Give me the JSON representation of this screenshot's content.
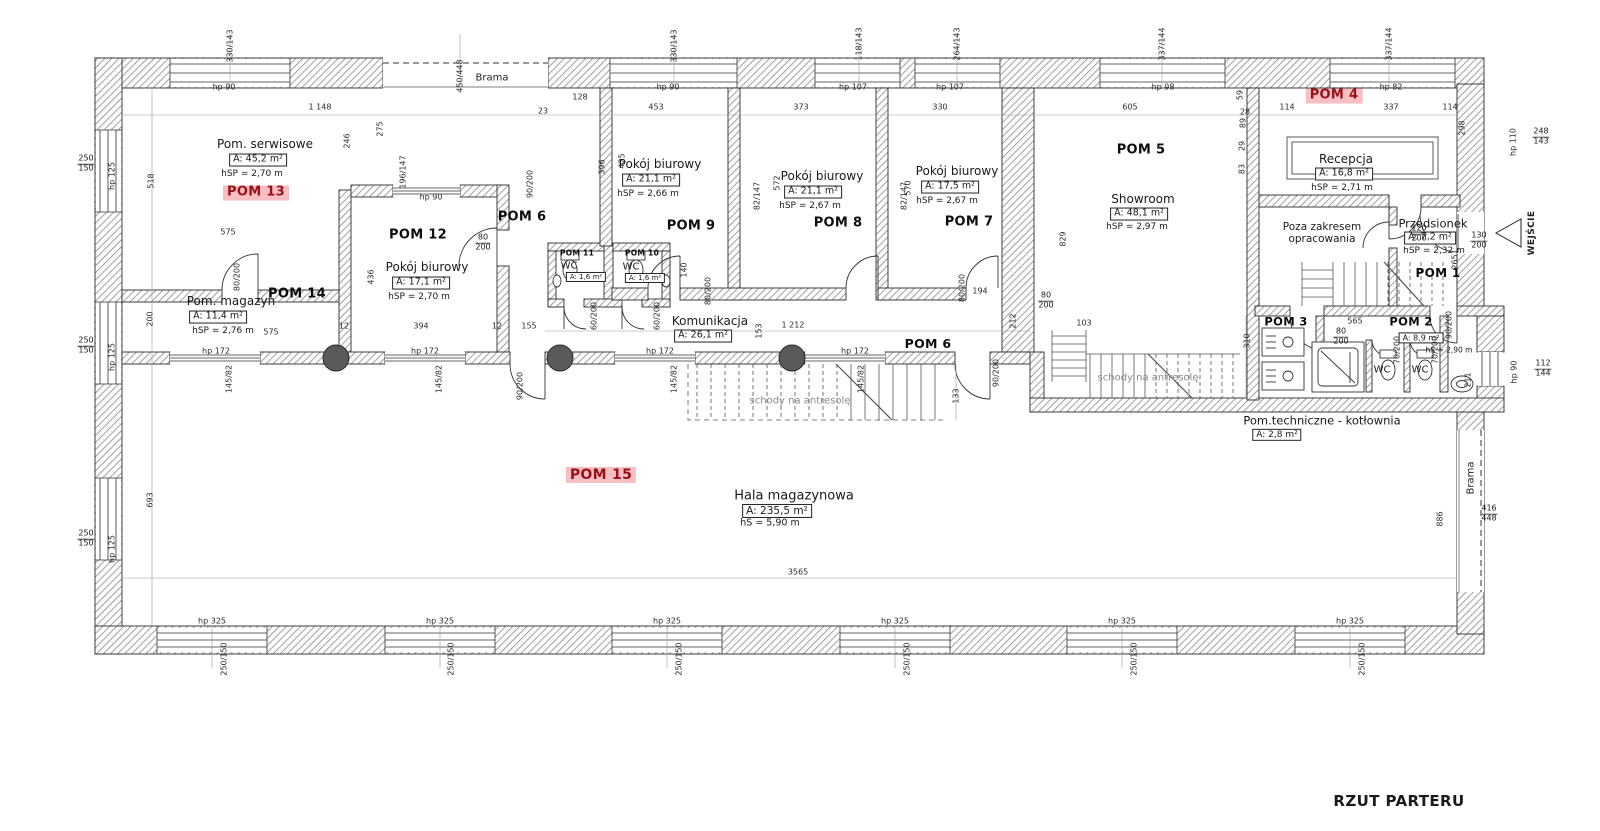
{
  "title": "RZUT PARTERU",
  "colors": {
    "highlight_bg": "#f7bfc4",
    "highlight_text": "#9a1016",
    "wall_hatch": "#8a8a8a"
  },
  "rooms": [
    {
      "key": "pom13",
      "id": "POM 13",
      "hl": true,
      "name": "Pom. serwisowe",
      "area": "A: 45,2 m²",
      "height": "hSP = 2,70 m",
      "bpos": [
        256,
        193
      ],
      "npos": [
        265,
        145
      ],
      "apos": [
        258,
        160
      ],
      "hpos": [
        252,
        174
      ]
    },
    {
      "key": "pom12",
      "id": "POM 12",
      "hl": false,
      "name": "Pokój biurowy",
      "area": "A: 17,1 m²",
      "height": "hSP = 2,70 m",
      "bpos": [
        418,
        236
      ],
      "npos": [
        427,
        268
      ],
      "apos": [
        421,
        283
      ],
      "hpos": [
        419,
        297
      ]
    },
    {
      "key": "pom14",
      "id": "POM 14",
      "hl": false,
      "name": "Pom. magazyn",
      "area": "A: 11,4 m²",
      "height": "hSP = 2,76 m",
      "bpos": [
        297,
        295
      ],
      "npos": [
        231,
        302
      ],
      "apos": [
        218,
        317
      ],
      "hpos": [
        223,
        331
      ]
    },
    {
      "key": "pom6-upper",
      "id": "POM 6",
      "hl": false,
      "name": null,
      "area": null,
      "height": null,
      "bpos": [
        522,
        218
      ]
    },
    {
      "key": "pom9",
      "id": "POM 9",
      "hl": false,
      "name": "Pokój biurowy",
      "area": "A: 21,1 m²",
      "height": "hSP = 2,66 m",
      "bpos": [
        691,
        227
      ],
      "npos": [
        660,
        165
      ],
      "apos": [
        651,
        180
      ],
      "hpos": [
        648,
        194
      ]
    },
    {
      "key": "pom8",
      "id": "POM 8",
      "hl": false,
      "name": "Pokój biurowy",
      "area": "A: 21,1 m²",
      "height": "hSP = 2,67 m",
      "bpos": [
        838,
        224
      ],
      "npos": [
        822,
        177
      ],
      "apos": [
        813,
        192
      ],
      "hpos": [
        810,
        206
      ]
    },
    {
      "key": "pom7",
      "id": "POM 7",
      "hl": false,
      "name": "Pokój biurowy",
      "area": "A: 17,5 m²",
      "height": "hSP = 2,67 m",
      "bpos": [
        969,
        223
      ],
      "npos": [
        957,
        172
      ],
      "apos": [
        950,
        187
      ],
      "hpos": [
        947,
        201
      ]
    },
    {
      "key": "pom5",
      "id": "POM 5",
      "hl": false,
      "name": "Showroom",
      "area": "A: 48,1 m²",
      "height": "hSP = 2,97 m",
      "bpos": [
        1141,
        151
      ],
      "npos": [
        1143,
        200
      ],
      "apos": [
        1139,
        214
      ],
      "hpos": [
        1137,
        227
      ]
    },
    {
      "key": "pom4",
      "id": "POM 4",
      "hl": true,
      "name": "Recepcja",
      "area": "A: 16,8 m²",
      "height": "hSP = 2,71 m",
      "bpos": [
        1334,
        96
      ],
      "npos": [
        1346,
        160
      ],
      "apos": [
        1344,
        174
      ],
      "hpos": [
        1342,
        188
      ]
    },
    {
      "key": "pom1",
      "id": "POM 1",
      "hl": false,
      "name": "Przedsionek",
      "area": "A: 7,2 m²",
      "height": "hSP = 2,32 m",
      "bpos": [
        1438,
        274
      ],
      "npos": [
        1433,
        224
      ],
      "apos": [
        1430,
        238
      ],
      "hpos": [
        1434,
        251
      ],
      "f": {
        "b": 12,
        "n": 11.5
      }
    },
    {
      "key": "pom11",
      "id": "POM 11",
      "hl": false,
      "name": "WC",
      "area": "A: 1,6 m²",
      "height": null,
      "bpos": [
        577,
        254
      ],
      "npos": [
        569,
        266
      ],
      "apos": [
        586,
        277
      ],
      "f": {
        "b": 7.5,
        "n": 10,
        "a": 7
      }
    },
    {
      "key": "pom10",
      "id": "POM 10",
      "hl": false,
      "name": "WC",
      "area": "A: 1,6 m²",
      "height": null,
      "bpos": [
        642,
        254
      ],
      "npos": [
        631,
        267
      ],
      "apos": [
        645,
        278
      ],
      "f": {
        "b": 7.5,
        "n": 10,
        "a": 7
      }
    },
    {
      "key": "komunikacja",
      "id": "POM 6",
      "hl": false,
      "name": "Komunikacja",
      "area": "A: 26,1 m²",
      "height": null,
      "bpos": [
        928,
        344
      ],
      "npos": [
        710,
        322
      ],
      "apos": [
        703,
        336
      ],
      "f": {
        "b": 12.5
      }
    },
    {
      "key": "pom3",
      "id": "POM 3",
      "hl": false,
      "name": null,
      "area": null,
      "height": null,
      "bpos": [
        1286,
        322
      ],
      "f": {
        "b": 11.5
      }
    },
    {
      "key": "pom2",
      "id": "POM 2",
      "hl": false,
      "name": null,
      "area": "A: 8,9 m²",
      "height": "hS = 2,90 m",
      "bpos": [
        1411,
        322
      ],
      "apos": [
        1421,
        338
      ],
      "hpos": [
        1449,
        351
      ],
      "f": {
        "b": 11.5,
        "a": 8,
        "h": 7.5
      }
    },
    {
      "key": "wc-left",
      "id": null,
      "hl": false,
      "name": "WC",
      "area": null,
      "height": null,
      "npos": [
        1382,
        370
      ],
      "f": {
        "n": 10
      }
    },
    {
      "key": "wc-right",
      "id": null,
      "hl": false,
      "name": "WC",
      "area": null,
      "height": null,
      "npos": [
        1420,
        370
      ],
      "f": {
        "n": 10
      }
    },
    {
      "key": "kotlownia",
      "id": null,
      "hl": false,
      "name": "Pom.techniczne - kotłownia",
      "area": "A: 2,8 m²",
      "height": null,
      "npos": [
        1322,
        421
      ],
      "apos": [
        1277,
        435
      ],
      "f": {
        "n": 11.5,
        "a": 9
      }
    },
    {
      "key": "pom15",
      "id": "POM 15",
      "hl": true,
      "name": "Hala magazynowa",
      "area": "A: 235,5 m²",
      "height": "hS = 5,90 m",
      "bpos": [
        601,
        475
      ],
      "npos": [
        794,
        497
      ],
      "apos": [
        777,
        511
      ],
      "hpos": [
        770,
        524
      ],
      "f": {
        "b": 14,
        "n": 13,
        "a": 10.5,
        "h": 9.5
      }
    },
    {
      "key": "poza-zakresem",
      "id": null,
      "hl": false,
      "name": "Poza zakresem\nopracowania",
      "area": null,
      "height": null,
      "npos": [
        1322,
        233
      ],
      "multi": true,
      "f": {
        "n": 10.5
      }
    }
  ],
  "annotations": [
    {
      "t": "Brama",
      "x": 492,
      "y": 78,
      "fl": ""
    },
    {
      "t": "Brama",
      "x": 1471,
      "y": 478,
      "fl": "r"
    },
    {
      "t": "WEJŚCIE",
      "x": 1532,
      "y": 233,
      "fl": "r b"
    },
    {
      "t": "schody na antresolę",
      "x": 800,
      "y": 401,
      "fl": "g"
    },
    {
      "t": "schody na antresolę",
      "x": 1148,
      "y": 378,
      "fl": "g"
    }
  ],
  "dims": [
    [
      "1 148",
      320,
      107,
      ""
    ],
    [
      "23",
      543,
      111,
      ""
    ],
    [
      "128",
      580,
      97,
      ""
    ],
    [
      "453",
      656,
      107,
      ""
    ],
    [
      "373",
      801,
      107,
      ""
    ],
    [
      "330",
      940,
      107,
      ""
    ],
    [
      "605",
      1130,
      107,
      ""
    ],
    [
      "28",
      1245,
      112,
      ""
    ],
    [
      "114",
      1287,
      107,
      ""
    ],
    [
      "337",
      1391,
      107,
      ""
    ],
    [
      "114",
      1450,
      107,
      ""
    ],
    [
      "330/143",
      230,
      46,
      "r"
    ],
    [
      "450/448",
      460,
      76,
      "r"
    ],
    [
      "330/143",
      674,
      46,
      "r"
    ],
    [
      "118/143",
      859,
      44,
      "r"
    ],
    [
      "264/143",
      957,
      44,
      "r"
    ],
    [
      "337/144",
      1162,
      44,
      "r"
    ],
    [
      "337/144",
      1389,
      44,
      "r"
    ],
    [
      "hp 90",
      224,
      87,
      ""
    ],
    [
      "hp 90",
      668,
      87,
      ""
    ],
    [
      "hp 107",
      853,
      87,
      ""
    ],
    [
      "hp 107",
      950,
      87,
      ""
    ],
    [
      "hp 98",
      1163,
      87,
      ""
    ],
    [
      "hp 82",
      1391,
      87,
      ""
    ],
    [
      "250/150",
      86,
      164,
      "f"
    ],
    [
      "250/150",
      86,
      346,
      "f"
    ],
    [
      "250/150",
      86,
      539,
      "f"
    ],
    [
      "hp 125",
      112,
      176,
      "r"
    ],
    [
      "hp 125",
      112,
      357,
      "r"
    ],
    [
      "hp 125",
      112,
      549,
      "r"
    ],
    [
      "518",
      151,
      181,
      "r"
    ],
    [
      "200",
      150,
      319,
      "r"
    ],
    [
      "693",
      150,
      500,
      "r"
    ],
    [
      "275",
      380,
      129,
      "r"
    ],
    [
      "246",
      347,
      141,
      "r"
    ],
    [
      "436",
      371,
      277,
      "r"
    ],
    [
      "396",
      602,
      167,
      "r"
    ],
    [
      "425",
      622,
      161,
      "r"
    ],
    [
      "572",
      777,
      183,
      "r"
    ],
    [
      "570",
      908,
      188,
      "r"
    ],
    [
      "829",
      1063,
      239,
      "r"
    ],
    [
      "59",
      1240,
      95,
      "r"
    ],
    [
      "89",
      1243,
      123,
      "r"
    ],
    [
      "29",
      1242,
      146,
      "r"
    ],
    [
      "83",
      1242,
      169,
      "r"
    ],
    [
      "298",
      1462,
      128,
      "r"
    ],
    [
      "248/143",
      1541,
      137,
      "f"
    ],
    [
      "hp 110",
      1513,
      142,
      "r"
    ],
    [
      "120/200",
      1419,
      234,
      "f"
    ],
    [
      "130/200",
      1479,
      241,
      "f"
    ],
    [
      "265",
      1455,
      262,
      "r"
    ],
    [
      "196/147",
      403,
      172,
      "r"
    ],
    [
      "hp 90",
      431,
      197,
      ""
    ],
    [
      "90/200",
      530,
      184,
      "r"
    ],
    [
      "80/200",
      483,
      243,
      "f"
    ],
    [
      "80/200",
      237,
      277,
      "r"
    ],
    [
      "82/147",
      757,
      196,
      "r"
    ],
    [
      "82/147",
      904,
      196,
      "r"
    ],
    [
      "80/200",
      708,
      291,
      "r"
    ],
    [
      "80/200",
      962,
      288,
      "r"
    ],
    [
      "60/200",
      594,
      316,
      "r"
    ],
    [
      "60/200",
      657,
      316,
      "r"
    ],
    [
      "140",
      684,
      270,
      "r"
    ],
    [
      "194",
      980,
      291,
      ""
    ],
    [
      "575",
      228,
      232,
      ""
    ],
    [
      "575",
      271,
      332,
      ""
    ],
    [
      "12",
      344,
      326,
      ""
    ],
    [
      "394",
      421,
      326,
      ""
    ],
    [
      "12",
      497,
      326,
      ""
    ],
    [
      "155",
      529,
      326,
      ""
    ],
    [
      "153",
      759,
      331,
      "r"
    ],
    [
      "1 212",
      793,
      325,
      ""
    ],
    [
      "hp 172",
      216,
      351,
      ""
    ],
    [
      "hp 172",
      425,
      351,
      ""
    ],
    [
      "hp 172",
      660,
      351,
      ""
    ],
    [
      "hp 172",
      855,
      351,
      ""
    ],
    [
      "145/82",
      229,
      379,
      "r"
    ],
    [
      "145/82",
      439,
      379,
      "r"
    ],
    [
      "145/82",
      674,
      379,
      "r"
    ],
    [
      "145/82",
      861,
      379,
      "r"
    ],
    [
      "90/200",
      520,
      386,
      "r"
    ],
    [
      "90/200",
      996,
      373,
      "r"
    ],
    [
      "212",
      1013,
      321,
      "r"
    ],
    [
      "103",
      1084,
      323,
      ""
    ],
    [
      "310",
      1247,
      341,
      "r"
    ],
    [
      "133",
      956,
      396,
      "r"
    ],
    [
      "80/200",
      1046,
      301,
      "f"
    ],
    [
      "565",
      1355,
      321,
      ""
    ],
    [
      "80/200",
      1341,
      337,
      "f"
    ],
    [
      "70/200",
      1397,
      350,
      "r"
    ],
    [
      "70/200",
      1435,
      350,
      "r"
    ],
    [
      "90/200",
      1449,
      325,
      "r"
    ],
    [
      "211",
      1468,
      380,
      "r"
    ],
    [
      "hp 90",
      1514,
      372,
      "r"
    ],
    [
      "112/144",
      1543,
      369,
      "f"
    ],
    [
      "886",
      1440,
      519,
      "r"
    ],
    [
      "416/448",
      1489,
      514,
      "f"
    ],
    [
      "3565",
      798,
      572,
      ""
    ],
    [
      "hp 325",
      212,
      621,
      ""
    ],
    [
      "hp 325",
      440,
      621,
      ""
    ],
    [
      "hp 325",
      667,
      621,
      ""
    ],
    [
      "hp 325",
      895,
      621,
      ""
    ],
    [
      "hp 325",
      1122,
      621,
      ""
    ],
    [
      "hp 325",
      1350,
      621,
      ""
    ],
    [
      "250/150",
      224,
      659,
      "r"
    ],
    [
      "250/150",
      451,
      659,
      "r"
    ],
    [
      "250/150",
      679,
      659,
      "r"
    ],
    [
      "250/150",
      907,
      659,
      "r"
    ],
    [
      "250/150",
      1134,
      659,
      "r"
    ],
    [
      "250/150",
      1362,
      659,
      "r"
    ]
  ]
}
